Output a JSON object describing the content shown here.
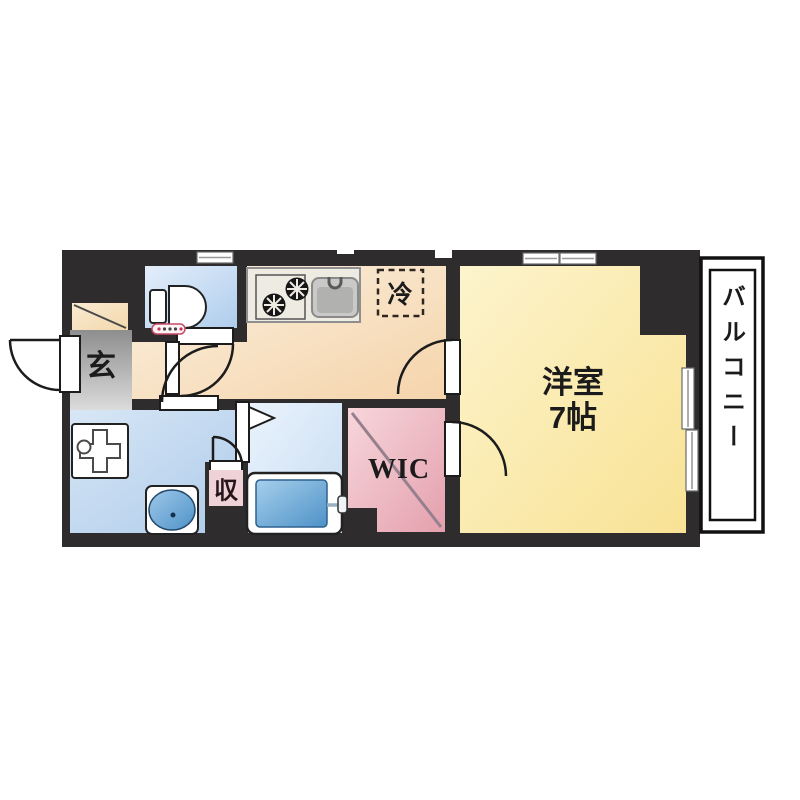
{
  "floor_plan": {
    "labels": {
      "entrance": "玄",
      "main_room_name": "洋室",
      "main_room_size": "7帖",
      "walk_in_closet": "WIC",
      "balcony": "バルコニー",
      "refrigerator": "冷",
      "storage": "収"
    },
    "colors": {
      "wall": "#2e2c2d",
      "main_room": "#f9e8a2",
      "kitchen": "#f7dcb4",
      "toilet": "#c3daf2",
      "bath": "#d9e8f7",
      "washroom": "#c0d5ed",
      "wic": "#eeb4bf",
      "genkan": "#b5b5b5",
      "shoe_cabinet": "#f6e0ba",
      "tub": "#5d9ed3",
      "storage_tag": "#eed2d8",
      "balcony": "#ffffff",
      "fridge_dash": "#2f2620"
    }
  }
}
